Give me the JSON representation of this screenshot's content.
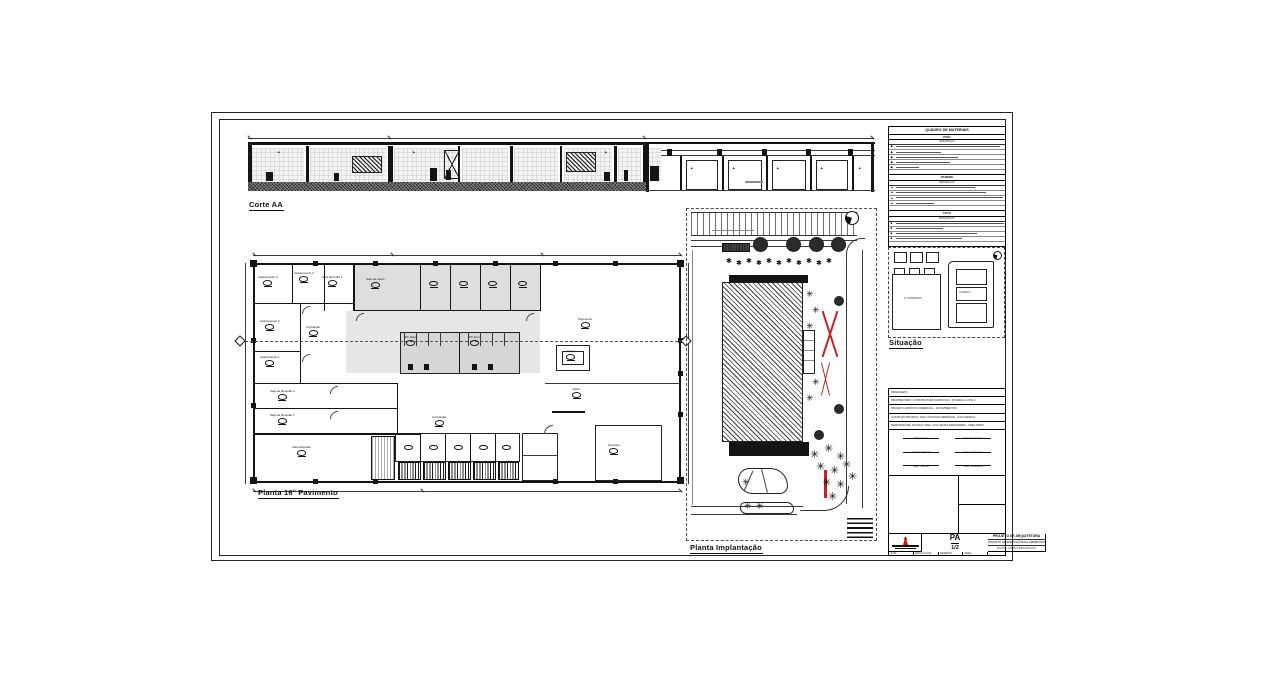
{
  "icons": {
    "palm": "✳",
    "shrub": "✱",
    "diamond": "◆",
    "triangle": "▲",
    "square": "■"
  },
  "sheet": {
    "section_label": "Corte AA",
    "plan_label": "Planta 16° Pavimento",
    "site_label": "Planta Implantação",
    "situacao_label": "Situação"
  },
  "floor_plan": {
    "rooms": [
      {
        "name": "Apartamento 3"
      },
      {
        "name": "Apartamento 4"
      },
      {
        "name": "Sala Reunião 1"
      },
      {
        "name": "Sala de Apoio"
      },
      {
        "name": "Apartamento 2"
      },
      {
        "name": "Apartamento 1"
      },
      {
        "name": "Circulação"
      },
      {
        "name": "Sala de Reunião 2"
      },
      {
        "name": "Sala de Reunião 1"
      },
      {
        "name": "Administração"
      },
      {
        "name": "Circulação"
      },
      {
        "name": "WC Masc."
      },
      {
        "name": "WC Fem."
      },
      {
        "name": "Copa"
      },
      {
        "name": "Pavimento"
      },
      {
        "name": "Estar"
      },
      {
        "name": "Depósito"
      }
    ]
  },
  "situacao": {
    "left_label": "R. TIRADENTES",
    "right_label": "QUADRA 2"
  },
  "materials": {
    "title": "QUADRO DE MATERIAIS",
    "col_header": "DESCRIÇÃO",
    "sections": [
      "PISO",
      "PAREDE",
      "TETO",
      "OBSERVAÇÕES"
    ]
  },
  "title_block": {
    "info_lines": [
      "PRANCHETA",
      "PROPRIETÁRIO: CONSTRUTORA SANTA IVAN - QUADRA L LOTE 2",
      "PROJETO: EDIFÍCIO COMERCIAL - 16 PAVIMENTOS",
      "AUTOR DO PROJETO: ARQ. GUSTAVO HENRIQUE - CAU A00000-0",
      "RESPONSÁVEL TÉCNICO: ENG. CIVIL MARIA FERNANDES - CREA 00000"
    ],
    "signatures": [
      "Proprietário",
      "Data / Assinatura",
      "Autor do Projeto",
      "Data / Assinatura",
      "Resp. Técnico",
      "Data / Assinatura"
    ],
    "project_title": "PROJETO DE ARQUITETURA",
    "project_subtitle": "PROJETO DE EDIFICAÇÕES E AMBIENTES",
    "project_line3": "PLANTA, CORTE E IMPLANTAÇÃO",
    "sheet_code": "PA",
    "sheet_number": "1/2",
    "footer": [
      "DATA",
      "ESCALA 1/100",
      "DESENHO",
      "ÁREA"
    ]
  }
}
